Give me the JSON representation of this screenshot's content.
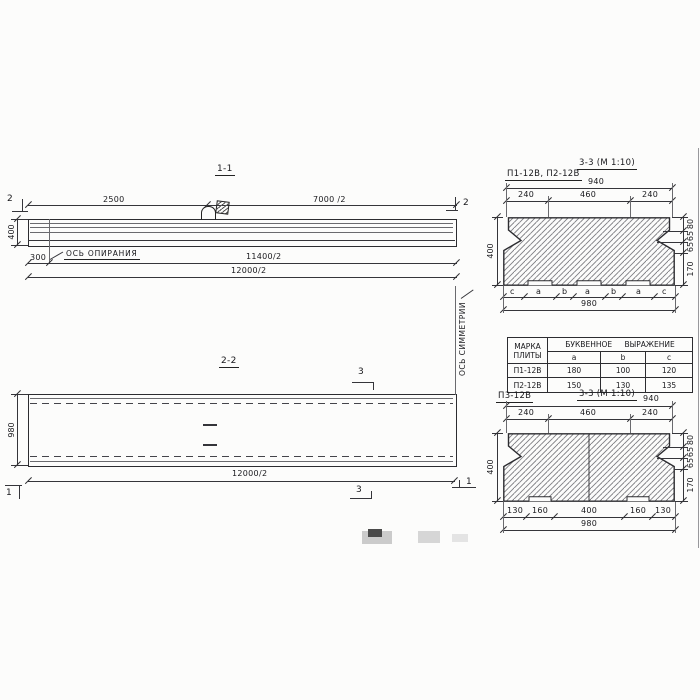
{
  "section11": {
    "title": "1-1",
    "dim_top_left": "2500",
    "dim_top_right": "7000 /2",
    "marker_left": "2",
    "marker_right": "2",
    "dim_height": "400",
    "dim_offset": "300",
    "bearing_axis_label": "ОСЬ ОПИРАНИЯ",
    "dim_mid": "11400/2",
    "dim_total": "12000/2"
  },
  "section22": {
    "title": "2-2",
    "marker_top": "3",
    "marker_bottom": "3",
    "marker_left": "1",
    "marker_right": "1",
    "dim_height": "980",
    "dim_total": "12000/2",
    "symmetry_axis_label": "ОСЬ СИММЕТРИИ"
  },
  "cross_top": {
    "label": "П1-12В, П2-12В",
    "title": "3-3 (М 1:10)",
    "top_total": "940",
    "top_segs": [
      "240",
      "460",
      "240"
    ],
    "height": "400",
    "right_segs": [
      "80",
      "65",
      "65",
      "170"
    ],
    "bottom_letters": [
      "c",
      "a",
      "b",
      "a",
      "b",
      "a",
      "c"
    ],
    "bottom_total": "980"
  },
  "cross_bottom": {
    "label": "П3-12В",
    "title": "3-3 (М 1:10)",
    "top_total": "940",
    "top_segs": [
      "240",
      "460",
      "240"
    ],
    "height": "400",
    "right_segs": [
      "80",
      "65",
      "65",
      "170"
    ],
    "bottom_segs": [
      "130",
      "160",
      "400",
      "160",
      "130"
    ],
    "bottom_total": "980"
  },
  "table": {
    "mark_header_line1": "МАРКА",
    "mark_header_line2": "ПЛИТЫ",
    "expr_header": "БУКВЕННОЕ ВЫРАЖЕНИЕ",
    "cols": [
      "a",
      "b",
      "c"
    ],
    "rows": [
      {
        "mark": "П1-12В",
        "a": "180",
        "b": "100",
        "c": "120"
      },
      {
        "mark": "П2-12В",
        "a": "150",
        "b": "130",
        "c": "135"
      }
    ]
  }
}
